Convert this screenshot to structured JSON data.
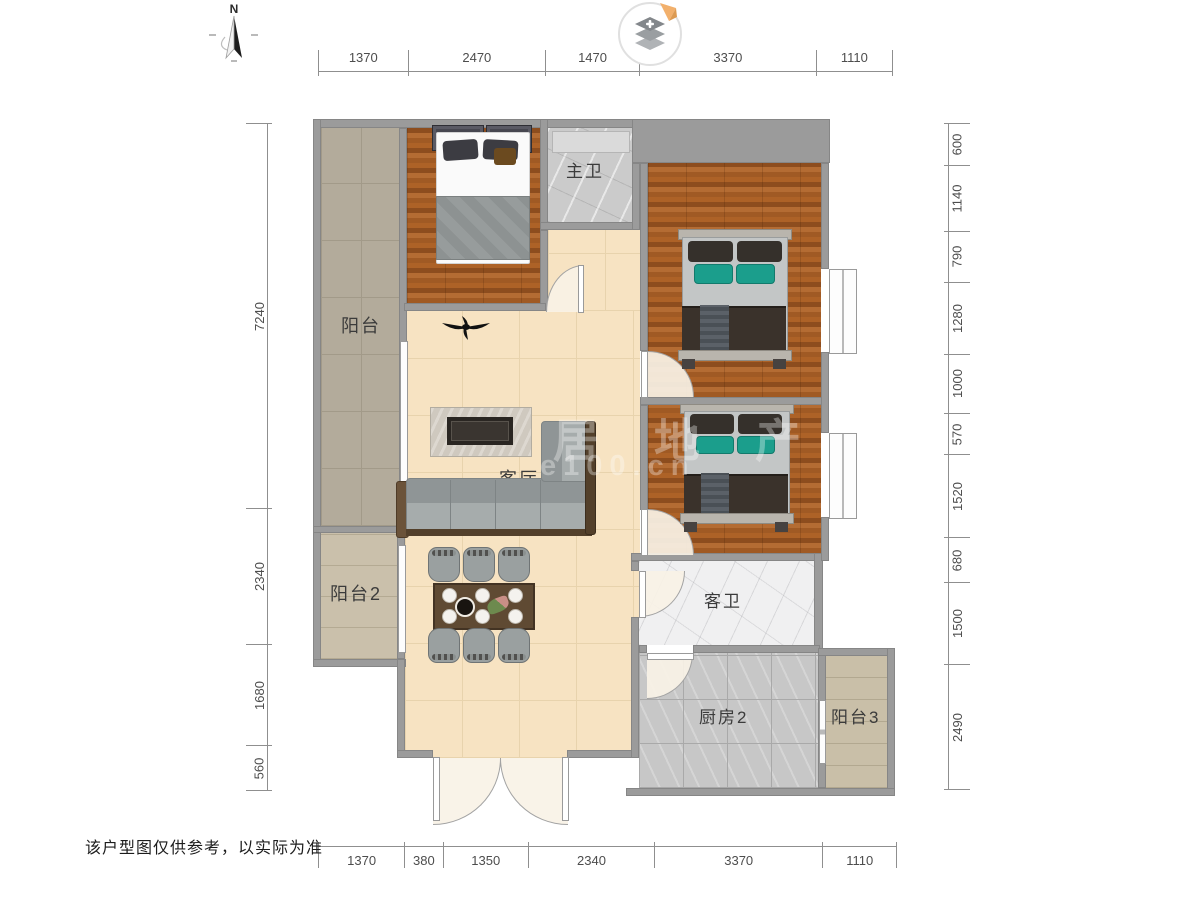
{
  "meta": {
    "north_label": "N",
    "disclaimer": "该户型图仅供参考，以实际为准"
  },
  "rooms": {
    "balcony1": "阳台",
    "balcony2": "阳台2",
    "balcony3": "阳台3",
    "master_bath": "主卫",
    "guest_bath": "客卫",
    "kitchen": "厨房2",
    "living": "客厅"
  },
  "dimensions": {
    "top": [
      "1370",
      "2470",
      "1470",
      "3370",
      "1110"
    ],
    "bottom": [
      "1370",
      "380",
      "1350",
      "2340",
      "3370",
      "1110"
    ],
    "left": [
      "7240",
      "2340",
      "1680",
      "560"
    ],
    "right": [
      "600",
      "1140",
      "790",
      "1280",
      "1000",
      "570",
      "1520",
      "680",
      "1500",
      "2490"
    ]
  },
  "watermark": {
    "line1": "居地产",
    "line2": "e100.cn"
  },
  "colors": {
    "wall": "#9b9b9b",
    "wood_floor": "#a05a24",
    "living_floor": "#f7e3c2",
    "teal_cushion": "#1b9e8c",
    "logo_ribbon": "#f2b06c"
  }
}
